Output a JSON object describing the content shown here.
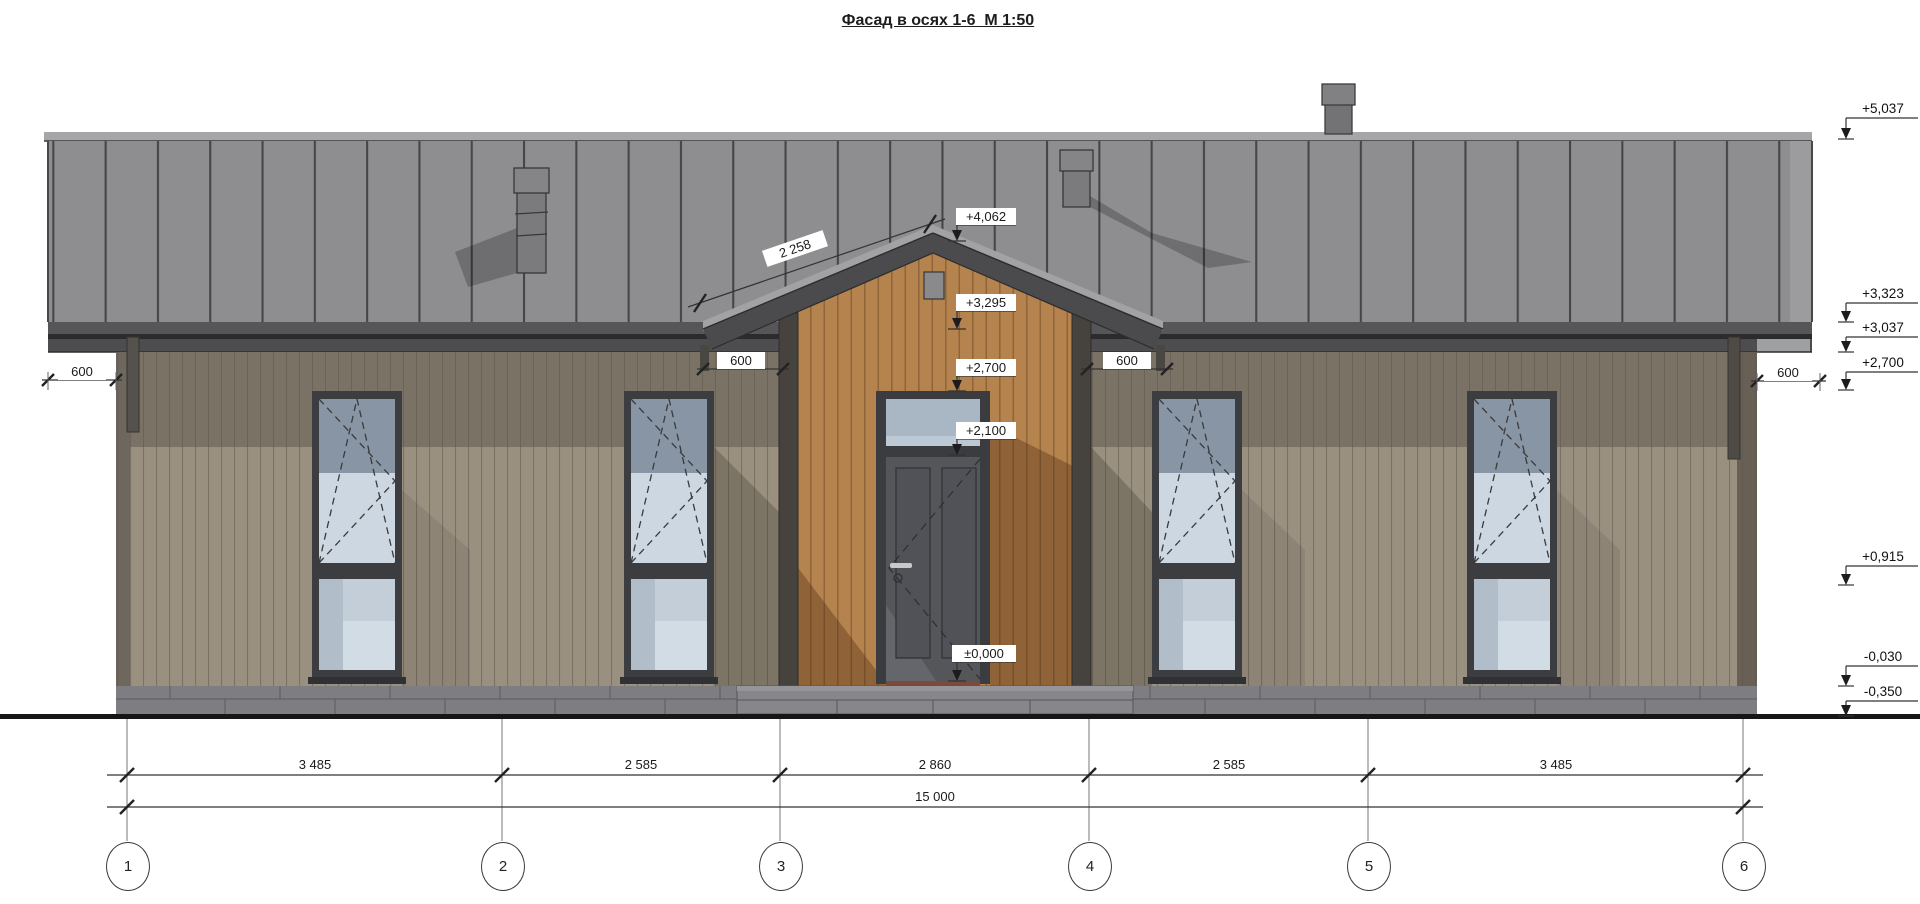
{
  "drawing": {
    "title": "Фасад в осях 1-6  М 1:50",
    "type_note": "facade elevation"
  },
  "elevations_right": [
    {
      "value": "+5,037"
    },
    {
      "value": "+3,323"
    },
    {
      "value": "+3,037"
    },
    {
      "value": "+2,700"
    },
    {
      "value": "+0,915"
    },
    {
      "value": "-0,030"
    },
    {
      "value": "-0,350"
    }
  ],
  "elevations_center": [
    {
      "value": "+4,062"
    },
    {
      "value": "+3,295"
    },
    {
      "value": "+2,700"
    },
    {
      "value": "+2,100"
    },
    {
      "value": "±0,000"
    }
  ],
  "dims": {
    "roof_slope": "2 258",
    "eave_left": "600",
    "gable_left": "600",
    "gable_right": "600",
    "eave_right": "600",
    "chain": [
      "3 485",
      "2 585",
      "2 860",
      "2 585",
      "3 485"
    ],
    "total": "15 000"
  },
  "axes": [
    {
      "label": "1"
    },
    {
      "label": "2"
    },
    {
      "label": "3"
    },
    {
      "label": "4"
    },
    {
      "label": "5"
    },
    {
      "label": "6"
    }
  ],
  "colors": {
    "roof_panels": "#8e8e91",
    "roof_cap": "#a6a6a9",
    "fascia": "#4b4b4d",
    "siding_light": "#99907f",
    "siding_shadow": "#7b7266",
    "gable_wood": "#b5834e",
    "gable_wood_shadow": "#8a5f36",
    "glass_light": "#cdd7e2",
    "glass_dark": "#8895a5",
    "door_leaf": "#55565a",
    "plinth": "#7e7e82",
    "ground_line": "#161616"
  }
}
